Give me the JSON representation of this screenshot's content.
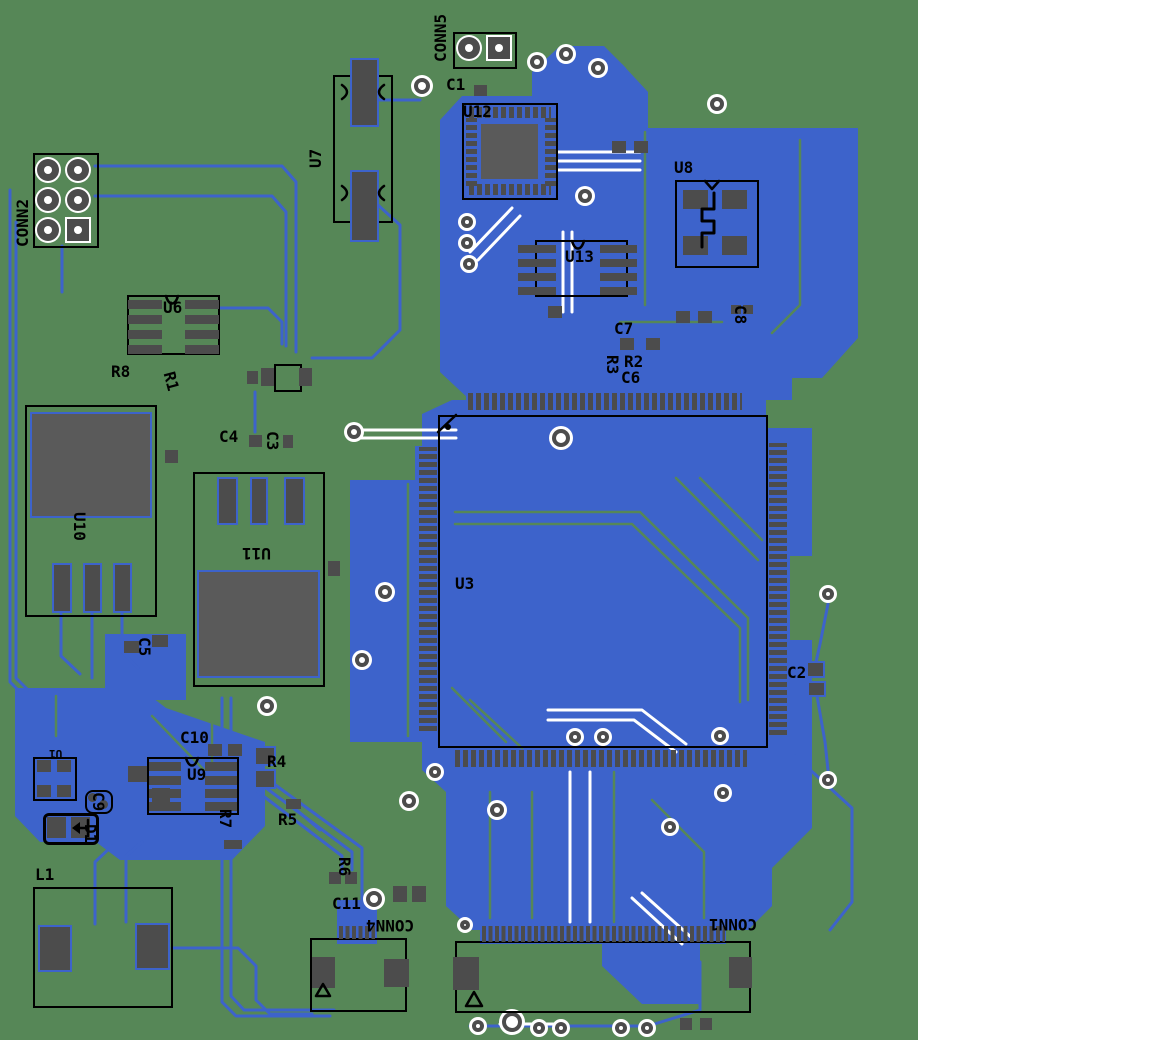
{
  "colors": {
    "board": "#568757",
    "copper": "#3d63cb",
    "pad": "#4c4c4c",
    "tab": "#5a5a5a",
    "silk": "#000000",
    "white": "#ffffff",
    "page": "#ffffff"
  },
  "labels": {
    "conn5": "CONN5",
    "conn2": "CONN2",
    "conn4": "CONN4",
    "conn1": "CONN1",
    "u1": "U1",
    "u3": "U3",
    "u6": "U6",
    "u7": "U7",
    "u8": "U8",
    "u9": "U9",
    "u10": "U10",
    "u11": "U11",
    "u12": "U12",
    "u13": "U13",
    "r1": "R1",
    "r2": "R2",
    "r3": "R3",
    "r4": "R4",
    "r5": "R5",
    "r6": "R6",
    "r7": "R7",
    "r8": "R8",
    "c1": "C1",
    "c2": "C2",
    "c3": "C3",
    "c4": "C4",
    "c5": "C5",
    "c6": "C6",
    "c7": "C7",
    "c8": "C8",
    "c9": "C9",
    "c10": "C10",
    "c11": "C11",
    "d1": "D1",
    "l1": "L1"
  }
}
